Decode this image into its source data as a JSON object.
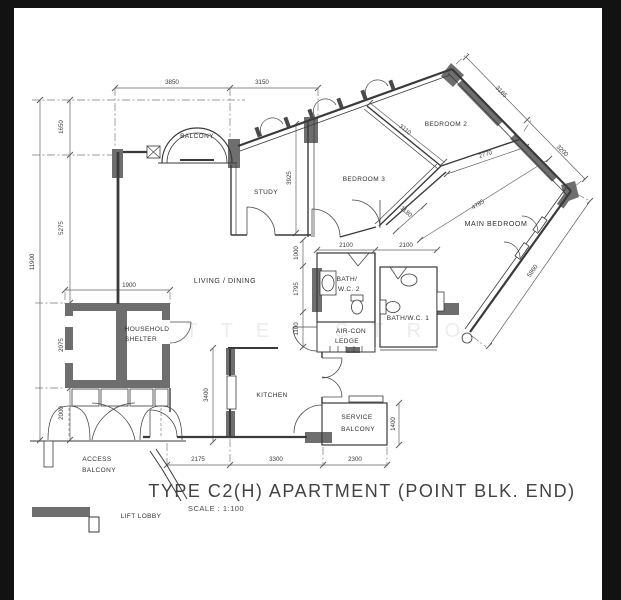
{
  "title": {
    "text": "TYPE C2(H) APARTMENT (POINT BLK. END)",
    "scale": "SCALE :  1:100"
  },
  "rooms": {
    "balcony": "BALCONY",
    "study": "STUDY",
    "bedroom3": "BEDROOM 3",
    "bedroom2": "BEDROOM 2",
    "main_bedroom": "MAIN BEDROOM",
    "living_dining": "LIVING / DINING",
    "household_line1": "HOUSEHOLD",
    "household_line2": "SHELTER",
    "bath2_line1": "BATH/",
    "bath2_line2": "W.C. 2",
    "bath1": "BATH/W.C. 1",
    "aircon_line1": "AIR-CON",
    "aircon_line2": "LEDGE",
    "kitchen": "KITCHEN",
    "service_line1": "SERVICE",
    "service_line2": "BALCONY",
    "access_line1": "ACCESS",
    "access_line2": "BALCONY",
    "lift_lobby": "LIFT LOBBY"
  },
  "dims": {
    "top_left": "3850",
    "top_right": "3150",
    "ne_upper": "3165",
    "ne_lower": "3200",
    "se_wall": "5860",
    "left_total": "11900",
    "left_seg1": "1650",
    "left_seg2": "5275",
    "left_seg3": "2075",
    "left_seg4": "2000",
    "shelter_width": "1900",
    "study_depth": "3925",
    "bed2_width": "3110",
    "bed2_depth": "2770",
    "main_nw": "4785",
    "hall": "1180",
    "mid_seg1": "1000",
    "mid_seg2": "1795",
    "mid_seg3": "1100",
    "bath2_width": "2100",
    "bath1_width": "2100",
    "kitchen_depth": "3400",
    "bottom_seg1": "2175",
    "bottom_seg2": "3300",
    "bottom_seg3": "2300",
    "service_depth": "1400"
  },
  "watermark": {
    "left": "T T E",
    "right": "S T R O"
  },
  "colors": {
    "frame": "#121212",
    "page": "#ffffff",
    "wall_gray": "#6e6e6e",
    "line": "#3a3a3a"
  }
}
